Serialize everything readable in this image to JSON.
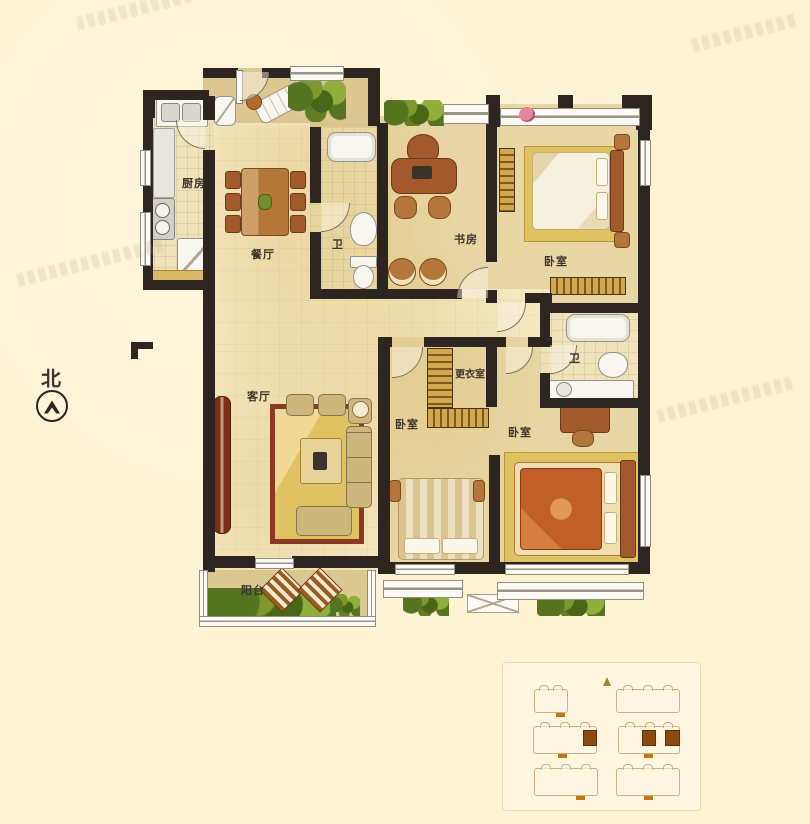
{
  "compass": {
    "north": "北"
  },
  "rooms": {
    "kitchen": "厨房",
    "dining": "餐厅",
    "bath_top": "卫",
    "study": "书房",
    "bedroom_master": "卧室",
    "living": "客厅",
    "dressing": "更衣室",
    "bath_right": "卫",
    "bedroom_mid": "卧室",
    "bedroom_right": "卧室",
    "balcony": "阳台"
  },
  "site_plan": {
    "buildings_visible": 6,
    "highlighted_units": 3
  },
  "colors": {
    "background": "#fdf3d2",
    "wall": "#2d2620",
    "floor": "#f4e9c2",
    "floor_bedroom": "#e8d7a5",
    "wood": "#a2592b",
    "unit_highlight": "#8a4a12"
  }
}
